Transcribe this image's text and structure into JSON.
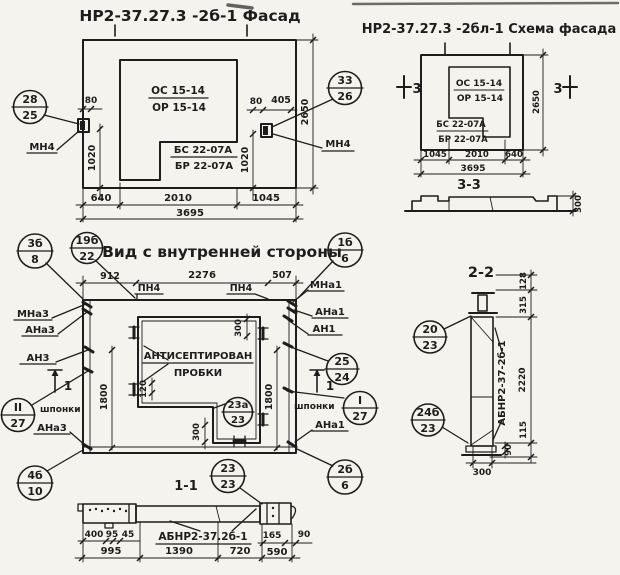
{
  "colors": {
    "paper": "#f4f3ee",
    "ink": "#1d1d1d"
  },
  "titles": {
    "facade": "НР2-37.27.3 -2б-1 Фасад",
    "schema": "НР2-37.27.3 -2бл-1 Схема фасада",
    "inner_view": "Вид с внутренней стороны",
    "s11": "1-1",
    "s22": "2-2",
    "s33": "3-3"
  },
  "facade": {
    "window_mark": {
      "top": "ОС 15-14",
      "bottom": "ОР 15-14"
    },
    "sill_mark": {
      "top": "БС 22-07А",
      "bottom": "БР 22-07А"
    },
    "callout_left": {
      "top": "28",
      "bottom": "25"
    },
    "callout_right": {
      "top": "33",
      "bottom": "26"
    },
    "anchor_left": "МН4",
    "anchor_right": "МН4",
    "dims": {
      "d80l": "80",
      "d80r": "80",
      "d405": "405",
      "d1020l": "1020",
      "d1020r": "1020",
      "d2650": "2650",
      "b1": "640",
      "b2": "2010",
      "b3": "1045",
      "total": "3695"
    }
  },
  "schema": {
    "window_mark": {
      "top": "ОС 15-14",
      "bottom": "ОР 15-14"
    },
    "sill_mark": {
      "top": "БС 22-07А",
      "bottom": "БР 22-07А"
    },
    "marker_left": "3",
    "marker_right": "3",
    "dims": {
      "b1": "1045",
      "b2": "2010",
      "b3": "640",
      "total": "3695",
      "d2650": "2650"
    }
  },
  "s33": {
    "dim300": "300"
  },
  "inner": {
    "callouts": {
      "c3b8": {
        "top": "3б",
        "bottom": "8"
      },
      "c19b22": {
        "top": "19б",
        "bottom": "22"
      },
      "c1b6": {
        "top": "1б",
        "bottom": "6"
      },
      "cII27": {
        "top": "II",
        "bottom": "27"
      },
      "cI27": {
        "top": "I",
        "bottom": "27"
      },
      "c2524": {
        "top": "25",
        "bottom": "24"
      },
      "c23a23": {
        "top": "23а",
        "bottom": "23"
      },
      "c2323": {
        "top": "23",
        "bottom": "23"
      },
      "c2b6": {
        "top": "2б",
        "bottom": "6"
      },
      "c4b10": {
        "top": "4б",
        "bottom": "10"
      }
    },
    "labels": {
      "pn4_1": "ПН4",
      "pn4_2": "ПН4",
      "mna3": "МНа3",
      "ana3_top": "АНа3",
      "an3": "АН3",
      "shponki_left": "шпонки",
      "ana3_bottom": "АНа3",
      "mna1": "МНа1",
      "ana1_top": "АНа1",
      "an1": "АН1",
      "shponki_right": "шпонки",
      "ana1_bottom": "АНа1",
      "note1": "АНТИСЕПТИРОВАН",
      "note2": "ПРОБКИ",
      "sec1l": "1",
      "sec1r": "1"
    },
    "dims": {
      "t1": "912",
      "t2": "2276",
      "t3": "507",
      "d1800l": "1800",
      "d1800r": "1800",
      "d300t": "300",
      "d120": "120",
      "d300b": "300"
    }
  },
  "s11": {
    "label": "АБНР2-37.2б-1",
    "dims": {
      "d400": "400",
      "d95": "95",
      "d45": "45",
      "b1": "995",
      "b2": "1390",
      "b3": "720",
      "b4": "590",
      "d165": "165",
      "d90": "90"
    }
  },
  "s22": {
    "label": "АБНР2-37-2б-1",
    "callout_top": {
      "top": "20",
      "bottom": "23"
    },
    "callout_bottom": {
      "top": "24б",
      "bottom": "23"
    },
    "dims": {
      "d128": "128",
      "d315": "315",
      "d2220": "2220",
      "d115": "115",
      "d90": "90",
      "d300": "300"
    }
  }
}
